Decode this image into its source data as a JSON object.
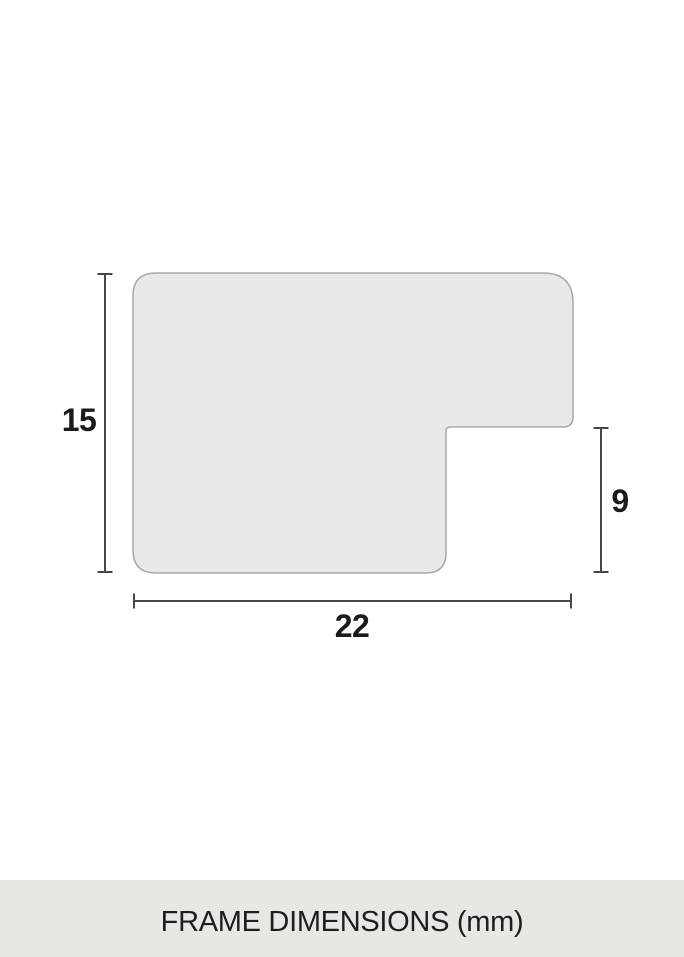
{
  "diagram": {
    "type": "frame-profile-cross-section",
    "dimension_labels": {
      "height": "15",
      "width": "22",
      "depth": "9"
    },
    "colors": {
      "shape_fill": "#e9e9e5",
      "shape_stroke": "#a9a9a3",
      "dimension_line": "#474747",
      "label_text": "#1b1b1b",
      "caption_band": "#e8e8e3",
      "background": "#ffffff"
    }
  },
  "caption": {
    "text": "FRAME DIMENSIONS (mm)"
  }
}
